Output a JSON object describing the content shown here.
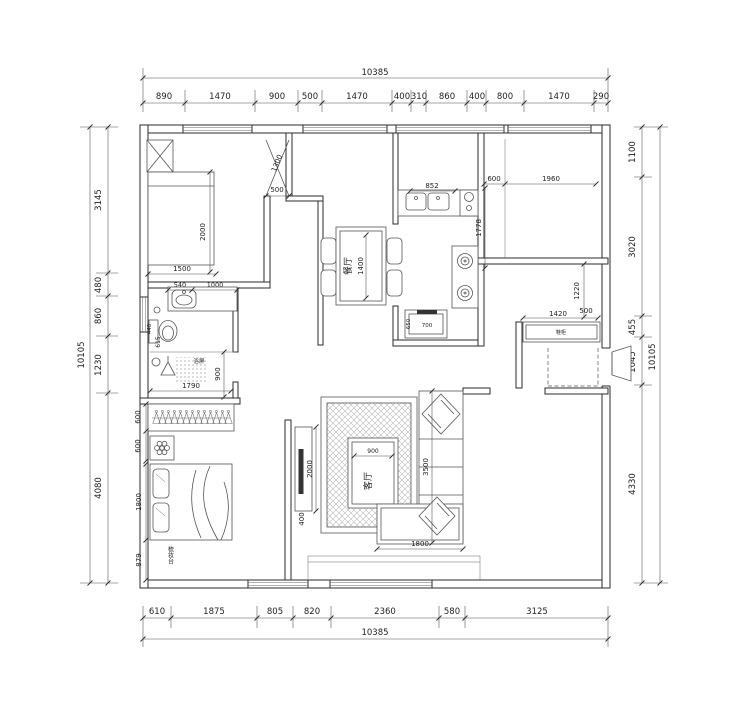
{
  "dimensions": {
    "top": {
      "total": "10385",
      "segments": [
        "890",
        "1470",
        "900",
        "500",
        "1470",
        "400",
        "310",
        "860",
        "400",
        "800",
        "1470",
        "290"
      ]
    },
    "bottom": {
      "total": "10385",
      "segments": [
        "610",
        "1875",
        "805",
        "820",
        "2360",
        "580",
        "3125"
      ]
    },
    "left": {
      "total": "10105",
      "segments": [
        "3145",
        "480",
        "860",
        "1230",
        "4080"
      ]
    },
    "right": {
      "total": "10105",
      "segments": [
        "1100",
        "3020",
        "455",
        "1045",
        "4330"
      ]
    }
  },
  "interior_dims": {
    "bedroom1_door": "1300",
    "bedroom1_door_offset": "500",
    "bed1_length": "2000",
    "bed1_width": "1500",
    "basin": "540",
    "basin_offset": "1000",
    "toilet_width": "440",
    "toilet_offset": "615",
    "shower_width": "1790",
    "shower_depth": "900",
    "wardrobe_depth": "600",
    "side_table": "600",
    "bed2_width": "1800",
    "dresser": "879",
    "sink": "852",
    "kitchen_length": "1778",
    "counter_width": "700",
    "counter_depth": "650",
    "dining_table_length": "1400",
    "bedroom3_offset": "600",
    "bedroom3_window": "1960",
    "entry_depth": "1220",
    "entry_offset": "500",
    "shoe_cabinet_width": "1420",
    "tv_cabinet_length": "2000",
    "tv_cabinet_depth": "400",
    "coffee_table_width": "900",
    "sofa_length": "3500",
    "sofa_chaise": "1800"
  },
  "labels": {
    "dining_room": "餐厅",
    "living_room": "客厅",
    "shower_screen": "浴屏",
    "dressing_table": "梳妆台",
    "shoe_cabinet": "鞋柜"
  }
}
